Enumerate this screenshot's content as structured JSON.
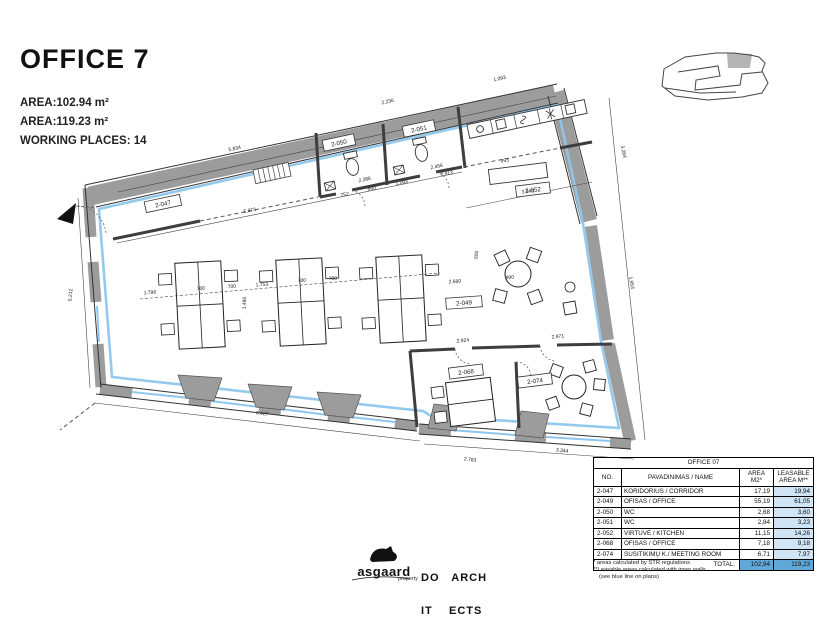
{
  "header": {
    "title": "OFFICE 7",
    "area1": "AREA:102.94 m²",
    "area2": "AREA:119.23 m²",
    "working_places": "WORKING PLACES: 14"
  },
  "plan": {
    "rooms": {
      "corridor": "2-047",
      "wc1": "2-050",
      "wc2": "2-051",
      "kitchen": "2-052",
      "office": "2-049",
      "office2": "2-068",
      "meeting": "2-074"
    },
    "dims": [
      "5.834",
      "2.236",
      "1.093",
      "3.284",
      "5.873",
      "752",
      "650",
      "1.093",
      "2.913",
      "993",
      "2.286",
      "2.456",
      "3.543",
      "1.953",
      "5.212",
      "2.680",
      "900",
      "1.798",
      "700",
      "700",
      "1.753",
      "700",
      "700",
      "1.490",
      "6.427",
      "2.924",
      "2.971",
      "2.783",
      "3.344",
      "600"
    ]
  },
  "icons": {
    "entrance_arrow": "black-triangle",
    "key_plan": "building-outline-with-highlight"
  },
  "colors": {
    "leasable_line": "#8ec6ed",
    "wall_gray": "#9c9c9c",
    "table_cell_blue": "#cfe4f4",
    "table_total_blue": "#5fa8d8"
  },
  "logos": {
    "asgaard": "asgaard",
    "asgaard_sub": "property",
    "doit_line1": "DO   ARCH",
    "doit_line2": "IT    ECTS"
  },
  "table": {
    "title": "OFFICE 07",
    "col_no": "NO.",
    "col_name": "PAVADINIMAS / NAME",
    "col_area": "AREA M2*",
    "col_leasable": "LEASABLE AREA M**",
    "rows": [
      [
        "2-047",
        "KORIDORIUS / CORRIDOR",
        "17,19",
        "19,94"
      ],
      [
        "2-049",
        "OFISAS / OFFICE",
        "55,19",
        "61,05"
      ],
      [
        "2-050",
        "WC",
        "2,68",
        "3,60"
      ],
      [
        "2-051",
        "WC",
        "2,84",
        "3,23"
      ],
      [
        "2-052",
        "VIRTUVĖ  / KITCHEN",
        "11,15",
        "14,26"
      ],
      [
        "2-068",
        "OFISAS / OFFICE",
        "7,18",
        "9,18"
      ],
      [
        "2-074",
        "SUSITIKIMŲ K./ MEETING ROOM",
        "6,71",
        "7,97"
      ]
    ],
    "total_label": "TOTAL:",
    "total_area": "102,94",
    "total_leasable": "119,23"
  },
  "footnotes": {
    "line1": "* areas calculated by STR regulations",
    "line2": "**Leasable areas calculated with inner walls",
    "line3": "(see blue line on plans)"
  }
}
